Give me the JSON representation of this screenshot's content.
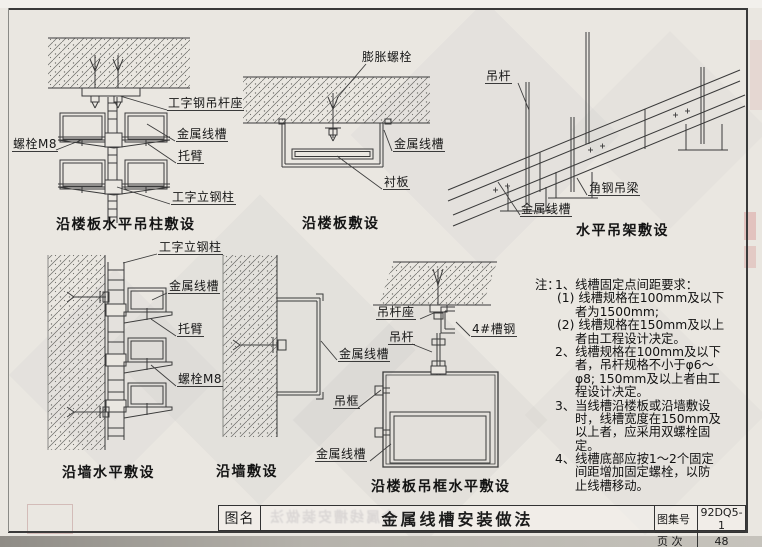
{
  "diagrams": {
    "d1": {
      "caption": "沿楼板水平吊柱敷设",
      "labels": {
        "bolt_m8": "螺栓M8",
        "i_steel_hanger_seat": "工字钢吊杆座",
        "metal_wireway": "金属线槽",
        "bracket_arm": "托臂",
        "i_steel_column": "工字立钢柱"
      }
    },
    "d2": {
      "caption": "沿楼板敷设",
      "labels": {
        "expansion_bolt": "膨胀螺栓",
        "metal_wireway": "金属线槽",
        "liner_plate": "衬板"
      }
    },
    "d3": {
      "caption": "水平吊架敷设",
      "labels": {
        "hanger_rod": "吊杆",
        "angle_steel_beam": "角钢吊梁",
        "metal_wireway": "金属线槽"
      }
    },
    "d4": {
      "caption": "沿墙水平敷设",
      "labels": {
        "i_steel_column": "工字立钢柱",
        "metal_wireway": "金属线槽",
        "bracket_arm": "托臂",
        "bolt_m8": "螺栓M8"
      }
    },
    "d5": {
      "caption": "沿墙敷设",
      "labels": {
        "metal_wireway": "金属线槽"
      }
    },
    "d6": {
      "caption": "沿楼板吊框水平敷设",
      "labels": {
        "hanger_rod_seat": "吊杆座",
        "channel_steel_4": "4#槽钢",
        "hanger_rod": "吊杆",
        "hanger_frame": "吊框",
        "metal_wireway": "金属线槽"
      }
    }
  },
  "notes": {
    "prefix": "注：",
    "lines": [
      {
        "text": "1、线槽固定点间距要求："
      },
      {
        "text": "(1) 线槽规格在100mm及以下"
      },
      {
        "text": "者为1500mm;"
      },
      {
        "text": "(2) 线槽规格在150mm及以上"
      },
      {
        "text": "者由工程设计决定。"
      },
      {
        "text": "2、线槽规格在100mm及以下"
      },
      {
        "text": "者，吊杆规格不小于φ6～"
      },
      {
        "text": "φ8; 150mm及以上者由工"
      },
      {
        "text": "程设计决定。"
      },
      {
        "text": "3、当线槽沿楼板或沿墙敷设"
      },
      {
        "text": "时，线槽宽度在150mm及"
      },
      {
        "text": "以上者，应采用双螺栓固"
      },
      {
        "text": "定。"
      },
      {
        "text": "4、线槽底部应按1～2个固定"
      },
      {
        "text": "间距增加固定螺栓，以防"
      },
      {
        "text": "止线槽移动。"
      }
    ]
  },
  "title_block": {
    "name_label": "图名",
    "drawing_title": "金属线槽安装做法",
    "atlas_no_label": "图集号",
    "atlas_no": "92DQ5-1",
    "page_label": "页 次",
    "page_no": "48"
  },
  "bleed": {
    "mirrored_title": "金属线槽安装做法"
  },
  "colors": {
    "paper": "#eae7e1",
    "line": "#3a3a3a",
    "text": "#1c1c1c"
  }
}
